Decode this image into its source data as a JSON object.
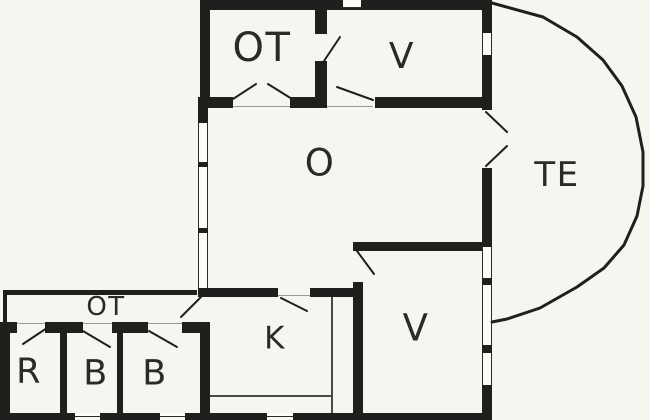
{
  "page": {
    "type": "architectural-floor-plan"
  },
  "colors": {
    "background": "#f6f5ef",
    "wall": "#1f1f1e",
    "text": "#2a2a28",
    "window_fill": "#fcfbf8",
    "window_frame": "#2c2c2c",
    "counter_line": "#4a4a46",
    "threshold": "#9a9a94"
  },
  "rooms": {
    "ot_top": {
      "label": "OT"
    },
    "v_top": {
      "label": "V"
    },
    "o": {
      "label": "O"
    },
    "te": {
      "label": "TE"
    },
    "ot_hall": {
      "label": "OT"
    },
    "r": {
      "label": "R"
    },
    "b1": {
      "label": "B"
    },
    "b2": {
      "label": "B"
    },
    "k": {
      "label": "K"
    },
    "v_bottom": {
      "label": "V"
    }
  }
}
